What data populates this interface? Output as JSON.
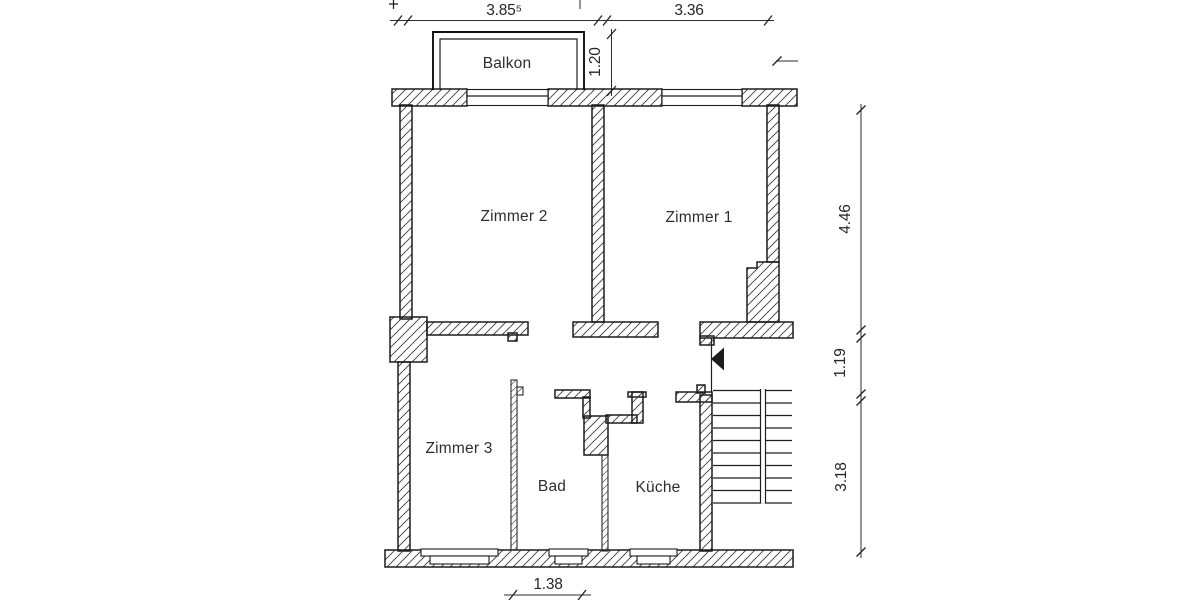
{
  "plan": {
    "room_labels": {
      "balkon": "Balkon",
      "zimmer2": "Zimmer 2",
      "zimmer1": "Zimmer 1",
      "zimmer3": "Zimmer 3",
      "bad": "Bad",
      "kueche": "Küche"
    },
    "dimensions": {
      "top_width_left": "3.85⁵",
      "top_width_right": "3.36",
      "balcony_depth": "1.20",
      "right_upper": "4.46",
      "right_middle": "1.19",
      "right_lower": "3.18",
      "bottom_bad_width": "1.38"
    },
    "colors": {
      "ink": "#1c1c1c",
      "paper": "#ffffff"
    }
  }
}
